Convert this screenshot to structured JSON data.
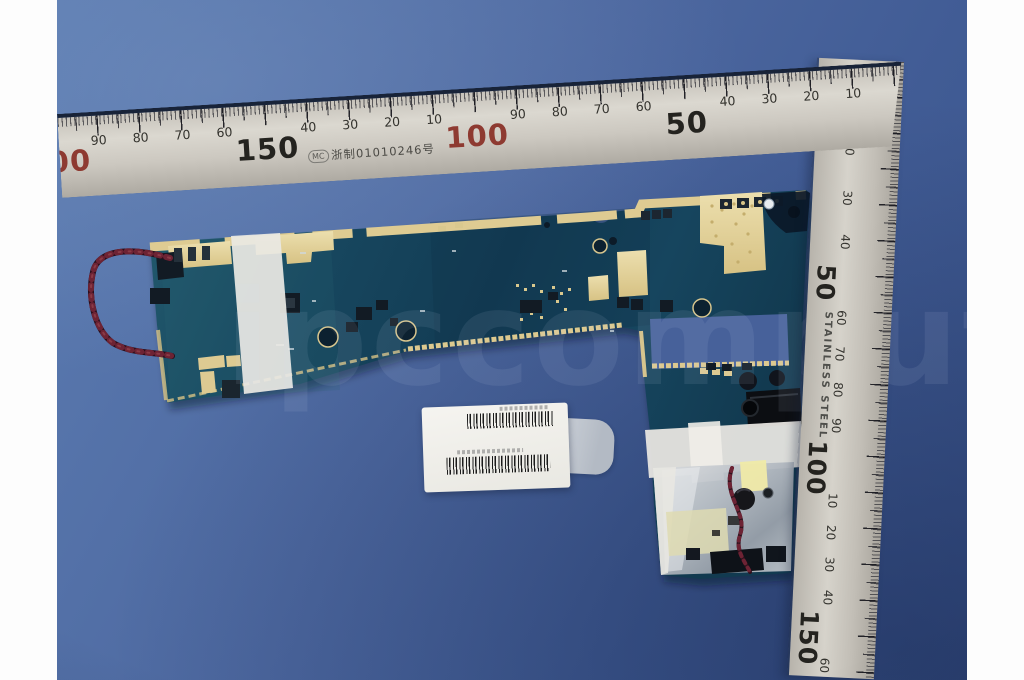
{
  "rulers": {
    "horizontal": {
      "mc_mark": "MC",
      "certification_text": "浙制01010246号",
      "big_labels": [
        "00",
        "150",
        "100",
        "50"
      ],
      "small_labels": [
        "90",
        "80",
        "70",
        "60",
        "40",
        "30",
        "20",
        "10",
        "90",
        "80",
        "70",
        "60",
        "40",
        "30",
        "20",
        "10"
      ]
    },
    "vertical": {
      "brand_text": "STAINLESS STEEL",
      "labels": [
        "10",
        "20",
        "30",
        "40",
        "50",
        "60",
        "70",
        "80",
        "90",
        "100",
        "10",
        "20",
        "30",
        "40",
        "150",
        "60"
      ]
    }
  },
  "watermark": {
    "text": "ipccomputer"
  },
  "colors": {
    "background_blue": "#4d68a0",
    "pcb_teal": "#16425c",
    "gold_pad": "#e3d2a0",
    "ruler_metal": "#cbc7bf",
    "red_number": "#8e3a31",
    "tape_white": "#eceae6"
  }
}
